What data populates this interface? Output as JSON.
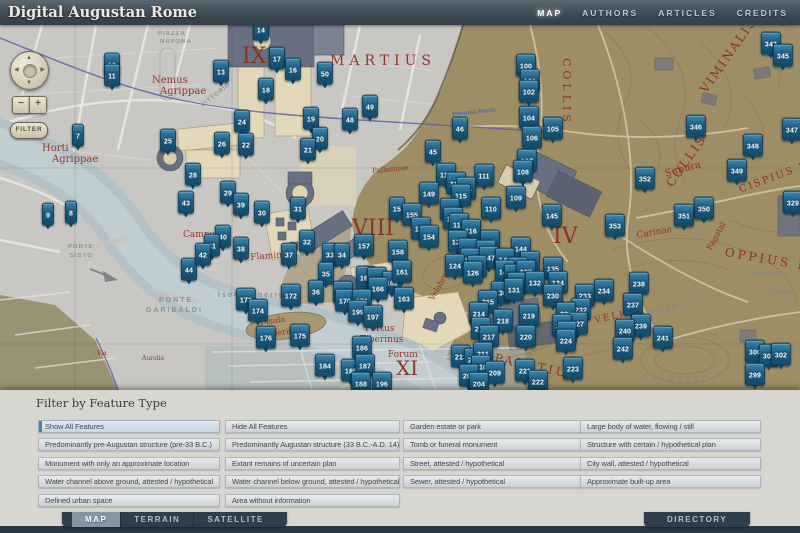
{
  "header": {
    "title": "Digital Augustan Rome",
    "nav": [
      {
        "label": "MAP",
        "active": true
      },
      {
        "label": "AUTHORS"
      },
      {
        "label": "ARTICLES"
      },
      {
        "label": "CREDITS"
      }
    ]
  },
  "map": {
    "controls": {
      "filter_label": "FILTER",
      "zoom_in": "+",
      "zoom_out": "−",
      "icons": {
        "pan_up": "▲",
        "pan_down": "▼",
        "pan_left": "◀",
        "pan_right": "▶"
      }
    },
    "labels_ancient": [
      {
        "t": "IX",
        "x": 242,
        "y": 46,
        "s": 22
      },
      {
        "t": "MARTIUS",
        "x": 330,
        "y": 54,
        "s": 14,
        "ls": 5
      },
      {
        "t": "VIII",
        "x": 352,
        "y": 218,
        "s": 22
      },
      {
        "t": "IV",
        "x": 553,
        "y": 226,
        "s": 22
      },
      {
        "t": "XI",
        "x": 396,
        "y": 358,
        "s": 20
      },
      {
        "t": "Nemus",
        "x": 152,
        "y": 76,
        "s": 10
      },
      {
        "t": "Agrippae",
        "x": 160,
        "y": 87,
        "s": 10
      },
      {
        "t": "Horti",
        "x": 42,
        "y": 144,
        "s": 10
      },
      {
        "t": "Agrippae",
        "x": 52,
        "y": 155,
        "s": 10
      },
      {
        "t": "COLLIS",
        "x": 572,
        "y": 58,
        "s": 11,
        "rot": 90,
        "ls": 4
      },
      {
        "t": "COLLIS",
        "x": 664,
        "y": 182,
        "s": 12,
        "rot": -55,
        "ls": 2
      },
      {
        "t": "VIMINALIS",
        "x": 698,
        "y": 88,
        "s": 12,
        "rot": -55,
        "ls": 2
      },
      {
        "t": "CISPIUS M",
        "x": 738,
        "y": 186,
        "s": 10,
        "rot": -20,
        "ls": 2
      },
      {
        "t": "OPPIUS M",
        "x": 726,
        "y": 246,
        "s": 12,
        "rot": 10,
        "ls": 3
      },
      {
        "t": "Subura",
        "x": 664,
        "y": 170,
        "s": 10,
        "rot": -15
      },
      {
        "t": "Carinae",
        "x": 636,
        "y": 232,
        "s": 9,
        "rot": -10
      },
      {
        "t": "Fagutal",
        "x": 706,
        "y": 248,
        "s": 8,
        "rot": -62
      },
      {
        "t": "VELIA",
        "x": 594,
        "y": 317,
        "s": 9,
        "ls": 2,
        "rot": -12
      },
      {
        "t": "Pallacinae",
        "x": 372,
        "y": 168,
        "s": 7,
        "rot": -5
      },
      {
        "t": "Flaminius",
        "x": 250,
        "y": 254,
        "s": 9,
        "rot": -5
      },
      {
        "t": "Campus",
        "x": 183,
        "y": 231,
        "s": 9
      },
      {
        "t": "Portus",
        "x": 365,
        "y": 325,
        "s": 9
      },
      {
        "t": "Tiberinus",
        "x": 360,
        "y": 336,
        "s": 9
      },
      {
        "t": "Insula",
        "x": 260,
        "y": 319,
        "s": 8,
        "rot": -8
      },
      {
        "t": "Tiberina",
        "x": 264,
        "y": 331,
        "s": 8,
        "rot": -8
      },
      {
        "t": "Forum",
        "x": 388,
        "y": 351,
        "s": 9
      },
      {
        "t": "PALATIUM",
        "x": 496,
        "y": 352,
        "s": 12,
        "rot": 12,
        "ls": 3
      },
      {
        "t": "Velabrum",
        "x": 428,
        "y": 298,
        "s": 8,
        "rot": -60
      },
      {
        "t": "Via",
        "x": 97,
        "y": 351,
        "s": 6
      },
      {
        "t": "Aurelia",
        "x": 142,
        "y": 356,
        "s": 6
      }
    ],
    "labels_modern": [
      {
        "t": "PIAZZA",
        "x": 158,
        "y": 31,
        "s": 6,
        "ls": 1
      },
      {
        "t": "NAVONA",
        "x": 160,
        "y": 39,
        "s": 6,
        "ls": 1
      },
      {
        "t": "VITTORIO",
        "x": 200,
        "y": 104,
        "s": 6,
        "rot": -38,
        "ls": 1
      },
      {
        "t": "Isola Tiberina",
        "x": 218,
        "y": 292,
        "s": 7,
        "ls": 2
      },
      {
        "t": "PONTE",
        "x": 159,
        "y": 297,
        "s": 7,
        "ls": 2
      },
      {
        "t": "GARIBALDI",
        "x": 146,
        "y": 307,
        "s": 7,
        "ls": 2
      },
      {
        "t": "PONTE",
        "x": 68,
        "y": 244,
        "s": 6,
        "ls": 1
      },
      {
        "t": "SISTO",
        "x": 70,
        "y": 253,
        "s": 6,
        "ls": 1
      },
      {
        "t": "COLOSSEO",
        "x": 642,
        "y": 375,
        "s": 8,
        "ls": 3
      },
      {
        "t": "IMPERIALI",
        "x": 647,
        "y": 311,
        "s": 7,
        "rot": -15,
        "ls": 2
      },
      {
        "t": "Colle Oppio",
        "x": 752,
        "y": 271,
        "s": 6
      },
      {
        "t": "Domus",
        "x": 770,
        "y": 289,
        "s": 6
      },
      {
        "t": "Petronia Amnis",
        "x": 452,
        "y": 112,
        "s": 6,
        "rot": -6,
        "color": "#4a5fa8"
      }
    ],
    "markers": [
      {
        "n": "14",
        "x": 261,
        "y": 31
      },
      {
        "n": "12",
        "x": 112,
        "y": 66
      },
      {
        "n": "11",
        "x": 112,
        "y": 77
      },
      {
        "n": "17",
        "x": 277,
        "y": 60
      },
      {
        "n": "13",
        "x": 221,
        "y": 73
      },
      {
        "n": "16",
        "x": 293,
        "y": 71
      },
      {
        "n": "50",
        "x": 325,
        "y": 75
      },
      {
        "n": "18",
        "x": 266,
        "y": 91
      },
      {
        "n": "49",
        "x": 370,
        "y": 108
      },
      {
        "n": "48",
        "x": 350,
        "y": 121
      },
      {
        "n": "24",
        "x": 242,
        "y": 123
      },
      {
        "n": "19",
        "x": 311,
        "y": 120
      },
      {
        "n": "20",
        "x": 320,
        "y": 140
      },
      {
        "n": "7",
        "x": 78,
        "y": 137
      },
      {
        "n": "25",
        "x": 168,
        "y": 142
      },
      {
        "n": "26",
        "x": 222,
        "y": 145
      },
      {
        "n": "22",
        "x": 246,
        "y": 146
      },
      {
        "n": "100",
        "x": 526,
        "y": 67
      },
      {
        "n": "101",
        "x": 530,
        "y": 82
      },
      {
        "n": "102",
        "x": 529,
        "y": 93
      },
      {
        "n": "104",
        "x": 529,
        "y": 119
      },
      {
        "n": "46",
        "x": 460,
        "y": 130
      },
      {
        "n": "105",
        "x": 553,
        "y": 130
      },
      {
        "n": "106",
        "x": 532,
        "y": 139
      },
      {
        "n": "343",
        "x": 771,
        "y": 45
      },
      {
        "n": "345",
        "x": 783,
        "y": 57
      },
      {
        "n": "346",
        "x": 696,
        "y": 128
      },
      {
        "n": "347",
        "x": 792,
        "y": 131
      },
      {
        "n": "348",
        "x": 753,
        "y": 147
      },
      {
        "n": "352",
        "x": 645,
        "y": 180
      },
      {
        "n": "349",
        "x": 737,
        "y": 172
      },
      {
        "n": "9",
        "x": 48,
        "y": 216
      },
      {
        "n": "8",
        "x": 71,
        "y": 214
      },
      {
        "n": "28",
        "x": 193,
        "y": 176
      },
      {
        "n": "43",
        "x": 186,
        "y": 204
      },
      {
        "n": "44",
        "x": 189,
        "y": 271
      },
      {
        "n": "21",
        "x": 308,
        "y": 151
      },
      {
        "n": "29",
        "x": 228,
        "y": 194
      },
      {
        "n": "39",
        "x": 241,
        "y": 206
      },
      {
        "n": "30",
        "x": 262,
        "y": 214
      },
      {
        "n": "31",
        "x": 298,
        "y": 210
      },
      {
        "n": "15",
        "x": 397,
        "y": 210
      },
      {
        "n": "40",
        "x": 223,
        "y": 238
      },
      {
        "n": "41",
        "x": 212,
        "y": 247
      },
      {
        "n": "38",
        "x": 241,
        "y": 250
      },
      {
        "n": "42",
        "x": 203,
        "y": 256
      },
      {
        "n": "32",
        "x": 307,
        "y": 243
      },
      {
        "n": "37",
        "x": 289,
        "y": 256
      },
      {
        "n": "33",
        "x": 330,
        "y": 256
      },
      {
        "n": "34",
        "x": 342,
        "y": 256
      },
      {
        "n": "157",
        "x": 364,
        "y": 247
      },
      {
        "n": "158",
        "x": 398,
        "y": 253
      },
      {
        "n": "45",
        "x": 433,
        "y": 153
      },
      {
        "n": "107",
        "x": 527,
        "y": 162
      },
      {
        "n": "108",
        "x": 523,
        "y": 173
      },
      {
        "n": "113",
        "x": 446,
        "y": 176
      },
      {
        "n": "111",
        "x": 484,
        "y": 177
      },
      {
        "n": "112",
        "x": 456,
        "y": 185
      },
      {
        "n": "114",
        "x": 466,
        "y": 190
      },
      {
        "n": "115",
        "x": 461,
        "y": 197
      },
      {
        "n": "149",
        "x": 429,
        "y": 195
      },
      {
        "n": "109",
        "x": 516,
        "y": 199
      },
      {
        "n": "110",
        "x": 491,
        "y": 210
      },
      {
        "n": "150",
        "x": 450,
        "y": 211
      },
      {
        "n": "155",
        "x": 412,
        "y": 216
      },
      {
        "n": "151",
        "x": 453,
        "y": 220
      },
      {
        "n": "145",
        "x": 552,
        "y": 217
      },
      {
        "n": "117",
        "x": 459,
        "y": 226
      },
      {
        "n": "116",
        "x": 471,
        "y": 232
      },
      {
        "n": "153",
        "x": 421,
        "y": 230
      },
      {
        "n": "154",
        "x": 429,
        "y": 238
      },
      {
        "n": "122",
        "x": 458,
        "y": 243
      },
      {
        "n": "119",
        "x": 490,
        "y": 243
      },
      {
        "n": "121",
        "x": 468,
        "y": 251
      },
      {
        "n": "146",
        "x": 486,
        "y": 253
      },
      {
        "n": "144",
        "x": 521,
        "y": 250
      },
      {
        "n": "118",
        "x": 470,
        "y": 261
      },
      {
        "n": "147",
        "x": 489,
        "y": 259
      },
      {
        "n": "141",
        "x": 505,
        "y": 261
      },
      {
        "n": "136",
        "x": 530,
        "y": 264
      },
      {
        "n": "124",
        "x": 455,
        "y": 267
      },
      {
        "n": "148",
        "x": 477,
        "y": 268
      },
      {
        "n": "135",
        "x": 553,
        "y": 270
      },
      {
        "n": "142",
        "x": 518,
        "y": 270
      },
      {
        "n": "350",
        "x": 704,
        "y": 210
      },
      {
        "n": "351",
        "x": 684,
        "y": 217
      },
      {
        "n": "329",
        "x": 793,
        "y": 204
      },
      {
        "n": "353",
        "x": 615,
        "y": 227
      },
      {
        "n": "35",
        "x": 326,
        "y": 275
      },
      {
        "n": "36",
        "x": 316,
        "y": 293
      },
      {
        "n": "172",
        "x": 291,
        "y": 297
      },
      {
        "n": "173",
        "x": 246,
        "y": 301
      },
      {
        "n": "174",
        "x": 258,
        "y": 312
      },
      {
        "n": "160",
        "x": 366,
        "y": 279
      },
      {
        "n": "164",
        "x": 377,
        "y": 280
      },
      {
        "n": "162",
        "x": 392,
        "y": 284
      },
      {
        "n": "166",
        "x": 378,
        "y": 290
      },
      {
        "n": "168",
        "x": 343,
        "y": 294
      },
      {
        "n": "170",
        "x": 345,
        "y": 302
      },
      {
        "n": "171",
        "x": 362,
        "y": 302
      },
      {
        "n": "199",
        "x": 358,
        "y": 313
      },
      {
        "n": "197",
        "x": 373,
        "y": 318
      },
      {
        "n": "175",
        "x": 300,
        "y": 337
      },
      {
        "n": "176",
        "x": 266,
        "y": 339
      },
      {
        "n": "186",
        "x": 362,
        "y": 349
      },
      {
        "n": "184",
        "x": 325,
        "y": 367
      },
      {
        "n": "185",
        "x": 351,
        "y": 372
      },
      {
        "n": "187",
        "x": 365,
        "y": 367
      },
      {
        "n": "188",
        "x": 361,
        "y": 385
      },
      {
        "n": "196",
        "x": 382,
        "y": 385
      },
      {
        "n": "161",
        "x": 402,
        "y": 273
      },
      {
        "n": "163",
        "x": 404,
        "y": 300
      },
      {
        "n": "126",
        "x": 473,
        "y": 274
      },
      {
        "n": "140",
        "x": 505,
        "y": 273
      },
      {
        "n": "138",
        "x": 514,
        "y": 277
      },
      {
        "n": "137",
        "x": 526,
        "y": 273
      },
      {
        "n": "139",
        "x": 517,
        "y": 285
      },
      {
        "n": "132",
        "x": 535,
        "y": 284
      },
      {
        "n": "130",
        "x": 501,
        "y": 294
      },
      {
        "n": "131",
        "x": 514,
        "y": 291
      },
      {
        "n": "134",
        "x": 558,
        "y": 284
      },
      {
        "n": "230",
        "x": 553,
        "y": 297
      },
      {
        "n": "233",
        "x": 585,
        "y": 297
      },
      {
        "n": "215",
        "x": 488,
        "y": 303
      },
      {
        "n": "214",
        "x": 479,
        "y": 315
      },
      {
        "n": "219",
        "x": 529,
        "y": 317
      },
      {
        "n": "232",
        "x": 581,
        "y": 311
      },
      {
        "n": "229",
        "x": 566,
        "y": 315
      },
      {
        "n": "218",
        "x": 503,
        "y": 322
      },
      {
        "n": "227",
        "x": 578,
        "y": 325
      },
      {
        "n": "216",
        "x": 481,
        "y": 330
      },
      {
        "n": "226",
        "x": 562,
        "y": 327
      },
      {
        "n": "217",
        "x": 489,
        "y": 338
      },
      {
        "n": "225",
        "x": 567,
        "y": 334
      },
      {
        "n": "220",
        "x": 526,
        "y": 338
      },
      {
        "n": "224",
        "x": 566,
        "y": 342
      },
      {
        "n": "213",
        "x": 461,
        "y": 358
      },
      {
        "n": "212",
        "x": 474,
        "y": 361
      },
      {
        "n": "211",
        "x": 483,
        "y": 355
      },
      {
        "n": "210",
        "x": 481,
        "y": 368
      },
      {
        "n": "209",
        "x": 495,
        "y": 374
      },
      {
        "n": "203",
        "x": 469,
        "y": 377
      },
      {
        "n": "204",
        "x": 479,
        "y": 385
      },
      {
        "n": "221",
        "x": 525,
        "y": 372
      },
      {
        "n": "223",
        "x": 573,
        "y": 370
      },
      {
        "n": "222",
        "x": 538,
        "y": 383
      },
      {
        "n": "238",
        "x": 639,
        "y": 285
      },
      {
        "n": "234",
        "x": 604,
        "y": 292
      },
      {
        "n": "237",
        "x": 633,
        "y": 306
      },
      {
        "n": "239",
        "x": 641,
        "y": 327
      },
      {
        "n": "240",
        "x": 625,
        "y": 332
      },
      {
        "n": "241",
        "x": 663,
        "y": 339
      },
      {
        "n": "242",
        "x": 623,
        "y": 350
      },
      {
        "n": "300",
        "x": 755,
        "y": 353
      },
      {
        "n": "301",
        "x": 769,
        "y": 357
      },
      {
        "n": "302",
        "x": 781,
        "y": 356
      },
      {
        "n": "299",
        "x": 755,
        "y": 376
      }
    ]
  },
  "filter_panel": {
    "title": "Filter by Feature Type",
    "buttons": [
      {
        "label": "Show All Features",
        "x": 38,
        "y": 30,
        "w": 174,
        "active": true
      },
      {
        "label": "Hide All Features",
        "x": 225,
        "y": 30,
        "w": 167
      },
      {
        "label": "Garden estate or park",
        "x": 403,
        "y": 30,
        "w": 170
      },
      {
        "label": "Large body of water, flowing / still",
        "x": 580,
        "y": 30,
        "w": 173
      },
      {
        "label": "Predominantly pre-Augustan structure (pre-33 B.C.)",
        "x": 38,
        "y": 48,
        "w": 174
      },
      {
        "label": "Predominantly Augustan structure (33 B.C.-A.D. 14)",
        "x": 225,
        "y": 48,
        "w": 167
      },
      {
        "label": "Tomb or funeral monument",
        "x": 403,
        "y": 48,
        "w": 170
      },
      {
        "label": "Structure with certain / hypothetical plan",
        "x": 580,
        "y": 48,
        "w": 173
      },
      {
        "label": "Monument with only an approximate location",
        "x": 38,
        "y": 67,
        "w": 174
      },
      {
        "label": "Extant remains of uncertain plan",
        "x": 225,
        "y": 67,
        "w": 167
      },
      {
        "label": "Street, attested / hypothetical",
        "x": 403,
        "y": 67,
        "w": 170
      },
      {
        "label": "City wall, attested / hypothetical",
        "x": 580,
        "y": 67,
        "w": 173
      },
      {
        "label": "Water channel above ground, attested / hypothetical",
        "x": 38,
        "y": 85,
        "w": 174
      },
      {
        "label": "Water channel below ground, attested / hypothetical",
        "x": 225,
        "y": 85,
        "w": 167
      },
      {
        "label": "Sewer, attested / hypothetical",
        "x": 403,
        "y": 85,
        "w": 170
      },
      {
        "label": "Approximate built-up area",
        "x": 580,
        "y": 85,
        "w": 173
      },
      {
        "label": "Defined urban space",
        "x": 38,
        "y": 104,
        "w": 174
      },
      {
        "label": "Area without information",
        "x": 225,
        "y": 104,
        "w": 167
      }
    ]
  },
  "footer": {
    "tabs_left": [
      {
        "label": "MAP",
        "active": true
      },
      {
        "label": "TERRAIN"
      },
      {
        "label": "SATELLITE"
      }
    ],
    "tabs_right": [
      {
        "label": "DIRECTORY"
      }
    ]
  }
}
